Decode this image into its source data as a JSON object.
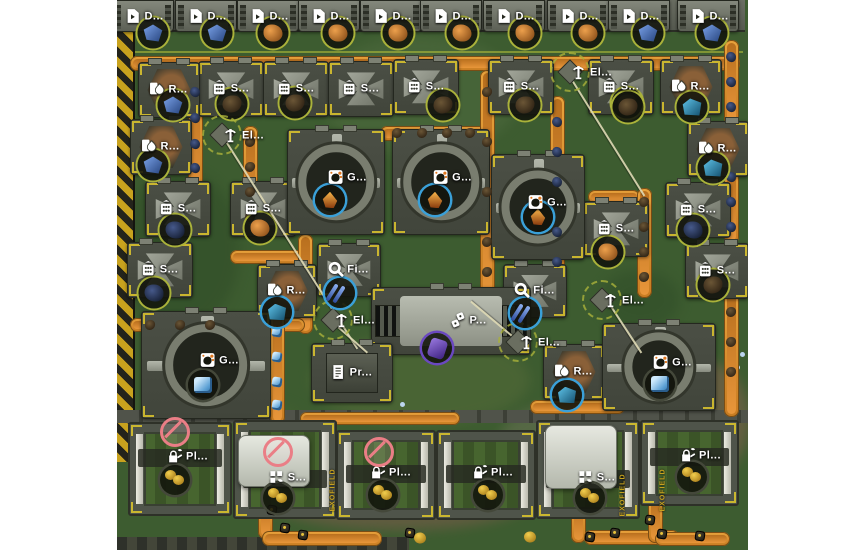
{
  "app": {
    "name": "factory-colony-game-map"
  },
  "labels": {
    "digger": "D...",
    "smelter": "S...",
    "refinery": "R...",
    "generator": "G...",
    "filter": "Fi...",
    "pole": "El...",
    "press": "P...",
    "printer": "Pr...",
    "planter": "Pl...",
    "sower": "S...",
    "exofield": "EXOFIELD"
  },
  "palette": {
    "page_bg": "#ffffff",
    "ground": "#3d5c30",
    "belt": "#d8902e",
    "hazard_yellow": "#c8a21e",
    "tile_grey": "#4b4f45",
    "ring_olive": "#aab23a",
    "ring_cyan": "#3aa0d8",
    "ring_purple": "#6a48c0",
    "label_text": "#ffffff",
    "prohibit_red": "#ea7e86",
    "exofield_gold": "#c8a21e"
  },
  "stage": {
    "left": 117,
    "top": 0,
    "width": 631,
    "height": 550
  },
  "diggers": {
    "y": 0,
    "w": 60,
    "h": 30,
    "xs": [
      142,
      205,
      267,
      328,
      390,
      450,
      513,
      577,
      638,
      707
    ]
  },
  "ore_nodes": [
    {
      "x": 153,
      "y": 33,
      "k": "blue"
    },
    {
      "x": 217,
      "y": 33,
      "k": "blue"
    },
    {
      "x": 273,
      "y": 33,
      "k": "orange"
    },
    {
      "x": 338,
      "y": 33,
      "k": "orange"
    },
    {
      "x": 398,
      "y": 33,
      "k": "orange"
    },
    {
      "x": 462,
      "y": 33,
      "k": "orange"
    },
    {
      "x": 525,
      "y": 33,
      "k": "orange"
    },
    {
      "x": 588,
      "y": 33,
      "k": "orange"
    },
    {
      "x": 648,
      "y": 33,
      "k": "blue"
    },
    {
      "x": 712,
      "y": 33,
      "k": "blue"
    },
    {
      "x": 232,
      "y": 104,
      "k": "dark"
    },
    {
      "x": 295,
      "y": 103,
      "k": "dark"
    },
    {
      "x": 443,
      "y": 105,
      "k": "dark"
    },
    {
      "x": 525,
      "y": 105,
      "k": "dark"
    },
    {
      "x": 627,
      "y": 103,
      "k": "dark"
    },
    {
      "x": 173,
      "y": 105,
      "k": "blue"
    },
    {
      "x": 692,
      "y": 107,
      "k": "teal"
    },
    {
      "x": 628,
      "y": 107,
      "k": "dark"
    },
    {
      "x": 153,
      "y": 165,
      "k": "blue"
    },
    {
      "x": 713,
      "y": 168,
      "k": "teal"
    },
    {
      "x": 175,
      "y": 230,
      "k": "darkblue"
    },
    {
      "x": 260,
      "y": 228,
      "k": "orange"
    },
    {
      "x": 154,
      "y": 293,
      "k": "darkblue"
    },
    {
      "x": 693,
      "y": 230,
      "k": "darkblue"
    },
    {
      "x": 713,
      "y": 285,
      "k": "dark"
    },
    {
      "x": 608,
      "y": 252,
      "k": "orange"
    }
  ],
  "buildings": [
    {
      "t": "smelter",
      "x": 230,
      "y": 88,
      "w": 64,
      "h": 54
    },
    {
      "t": "smelter",
      "x": 295,
      "y": 88,
      "w": 64,
      "h": 54
    },
    {
      "t": "smelter",
      "x": 360,
      "y": 88,
      "w": 64,
      "h": 54
    },
    {
      "t": "smelter",
      "x": 425,
      "y": 86,
      "w": 64,
      "h": 54
    },
    {
      "t": "smelter",
      "x": 520,
      "y": 86,
      "w": 64,
      "h": 54
    },
    {
      "t": "smelter",
      "x": 620,
      "y": 86,
      "w": 64,
      "h": 54
    },
    {
      "t": "smelter",
      "x": 177,
      "y": 208,
      "w": 64,
      "h": 54
    },
    {
      "t": "smelter",
      "x": 262,
      "y": 208,
      "w": 64,
      "h": 54
    },
    {
      "t": "smelter",
      "x": 159,
      "y": 269,
      "w": 64,
      "h": 54
    },
    {
      "t": "smelter",
      "x": 615,
      "y": 228,
      "w": 64,
      "h": 54
    },
    {
      "t": "smelter",
      "x": 697,
      "y": 209,
      "w": 64,
      "h": 54
    },
    {
      "t": "smelter",
      "x": 716,
      "y": 270,
      "w": 62,
      "h": 54
    },
    {
      "t": "refinery",
      "x": 168,
      "y": 89,
      "w": 60,
      "h": 54
    },
    {
      "t": "refinery",
      "x": 690,
      "y": 86,
      "w": 60,
      "h": 54
    },
    {
      "t": "refinery",
      "x": 160,
      "y": 146,
      "w": 60,
      "h": 54
    },
    {
      "t": "refinery",
      "x": 717,
      "y": 148,
      "w": 60,
      "h": 54
    },
    {
      "t": "refinery",
      "x": 286,
      "y": 290,
      "w": 58,
      "h": 52
    },
    {
      "t": "refinery",
      "x": 573,
      "y": 371,
      "w": 60,
      "h": 54
    },
    {
      "t": "filter",
      "x": 348,
      "y": 269,
      "w": 62,
      "h": 52
    },
    {
      "t": "filter",
      "x": 534,
      "y": 290,
      "w": 62,
      "h": 52
    },
    {
      "t": "generator",
      "x": 335,
      "y": 181,
      "w": 96,
      "h": 104,
      "dx": 12
    },
    {
      "t": "generator",
      "x": 440,
      "y": 181,
      "w": 96,
      "h": 104,
      "dx": 12
    },
    {
      "t": "generator",
      "x": 537,
      "y": 206,
      "w": 92,
      "h": 104,
      "dx": 10
    },
    {
      "t": "generator",
      "x": 205,
      "y": 364,
      "w": 128,
      "h": 106,
      "dx": 14
    },
    {
      "t": "generator",
      "x": 658,
      "y": 366,
      "w": 112,
      "h": 86,
      "dx": 14
    },
    {
      "t": "press",
      "x": 450,
      "y": 320,
      "w": 158,
      "h": 66,
      "dx": 18
    },
    {
      "t": "printer",
      "x": 351,
      "y": 372,
      "w": 80,
      "h": 58
    }
  ],
  "poles": [
    {
      "x": 222,
      "y": 135
    },
    {
      "x": 570,
      "y": 72
    },
    {
      "x": 333,
      "y": 320
    },
    {
      "x": 518,
      "y": 342
    },
    {
      "x": 602,
      "y": 300
    }
  ],
  "products": [
    {
      "x": 330,
      "y": 200,
      "k": "flame",
      "ring": "cyan"
    },
    {
      "x": 435,
      "y": 200,
      "k": "flame",
      "ring": "cyan"
    },
    {
      "x": 538,
      "y": 217,
      "k": "flame",
      "ring": "cyan"
    },
    {
      "x": 340,
      "y": 293,
      "k": "sticks",
      "ring": "cyan"
    },
    {
      "x": 525,
      "y": 313,
      "k": "sticks",
      "ring": "cyan"
    },
    {
      "x": 437,
      "y": 348,
      "k": "purple",
      "ring": "purple"
    },
    {
      "x": 203,
      "y": 385,
      "k": "glass",
      "ring": "dark"
    },
    {
      "x": 660,
      "y": 384,
      "k": "glass",
      "ring": "dark"
    },
    {
      "x": 567,
      "y": 395,
      "k": "teal",
      "ring": "cyan"
    },
    {
      "x": 277,
      "y": 312,
      "k": "teal",
      "ring": "cyan"
    },
    {
      "x": 175,
      "y": 480,
      "k": "fruit",
      "ring": "dark"
    },
    {
      "x": 278,
      "y": 498,
      "k": "fruit",
      "ring": "dark"
    },
    {
      "x": 383,
      "y": 495,
      "k": "fruit",
      "ring": "dark"
    },
    {
      "x": 488,
      "y": 495,
      "k": "fruit",
      "ring": "dark"
    },
    {
      "x": 590,
      "y": 498,
      "k": "fruit",
      "ring": "dark"
    },
    {
      "x": 692,
      "y": 477,
      "k": "fruit",
      "ring": "dark"
    }
  ],
  "belts": [
    [
      130,
      56,
      610,
      15
    ],
    [
      188,
      70,
      15,
      140
    ],
    [
      243,
      126,
      15,
      112
    ],
    [
      230,
      250,
      80,
      14
    ],
    [
      298,
      234,
      15,
      100
    ],
    [
      380,
      126,
      108,
      15
    ],
    [
      480,
      70,
      15,
      240
    ],
    [
      550,
      96,
      15,
      190
    ],
    [
      588,
      190,
      52,
      14
    ],
    [
      637,
      188,
      15,
      110
    ],
    [
      724,
      40,
      15,
      85
    ],
    [
      724,
      166,
      15,
      78
    ],
    [
      130,
      318,
      175,
      14
    ],
    [
      270,
      312,
      15,
      112
    ],
    [
      724,
      292,
      15,
      125
    ],
    [
      530,
      400,
      95,
      14
    ],
    [
      300,
      412,
      160,
      13
    ],
    [
      258,
      497,
      15,
      42
    ],
    [
      262,
      531,
      120,
      15
    ],
    [
      571,
      503,
      15,
      40
    ],
    [
      584,
      530,
      95,
      15
    ],
    [
      648,
      498,
      15,
      45
    ],
    [
      655,
      532,
      75,
      14
    ]
  ],
  "belt_items": [
    [
      195,
      92,
      "blue"
    ],
    [
      195,
      118,
      "blue"
    ],
    [
      195,
      144,
      "blue"
    ],
    [
      195,
      168,
      "blue"
    ],
    [
      557,
      122,
      "blue"
    ],
    [
      557,
      152,
      "blue"
    ],
    [
      557,
      182,
      "blue"
    ],
    [
      557,
      232,
      "blue"
    ],
    [
      557,
      262,
      "blue"
    ],
    [
      731,
      57,
      "blue"
    ],
    [
      731,
      82,
      "blue"
    ],
    [
      731,
      107,
      "blue"
    ],
    [
      731,
      177,
      "blue"
    ],
    [
      731,
      202,
      "blue"
    ],
    [
      731,
      227,
      "blue"
    ],
    [
      250,
      142,
      "dark"
    ],
    [
      250,
      167,
      "dark"
    ],
    [
      250,
      192,
      "dark"
    ],
    [
      250,
      217,
      "dark"
    ],
    [
      397,
      133,
      "dark"
    ],
    [
      422,
      133,
      "dark"
    ],
    [
      447,
      133,
      "dark"
    ],
    [
      470,
      133,
      "dark"
    ],
    [
      487,
      92,
      "dark"
    ],
    [
      487,
      142,
      "dark"
    ],
    [
      487,
      192,
      "dark"
    ],
    [
      487,
      242,
      "dark"
    ],
    [
      487,
      272,
      "dark"
    ],
    [
      644,
      202,
      "dark"
    ],
    [
      644,
      227,
      "dark"
    ],
    [
      644,
      252,
      "dark"
    ],
    [
      644,
      277,
      "dark"
    ],
    [
      731,
      312,
      "dark"
    ],
    [
      731,
      342,
      "dark"
    ],
    [
      731,
      372,
      "dark"
    ],
    [
      150,
      325,
      "dark"
    ],
    [
      180,
      325,
      "dark"
    ],
    [
      210,
      325,
      "dark"
    ],
    [
      277,
      332,
      "glass"
    ],
    [
      277,
      357,
      "glass"
    ],
    [
      277,
      382,
      "glass"
    ],
    [
      277,
      405,
      "glass"
    ],
    [
      272,
      510,
      "seed"
    ],
    [
      285,
      528,
      "seed"
    ],
    [
      303,
      535,
      "seed"
    ],
    [
      410,
      533,
      "seed"
    ],
    [
      590,
      537,
      "seed"
    ],
    [
      615,
      533,
      "seed"
    ],
    [
      650,
      520,
      "seed"
    ],
    [
      662,
      534,
      "seed"
    ],
    [
      700,
      536,
      "seed"
    ],
    [
      420,
      538,
      "fruitS"
    ],
    [
      530,
      537,
      "fruitS"
    ]
  ],
  "power_lines": [
    [
      225,
      138,
      358,
      348
    ],
    [
      570,
      75,
      645,
      195
    ],
    [
      610,
      303,
      642,
      352
    ],
    [
      520,
      344,
      470,
      302
    ],
    [
      335,
      323,
      368,
      352
    ]
  ],
  "fields": [
    {
      "x": 128,
      "y": 422,
      "w": 100,
      "h": 90,
      "t": "planter",
      "lx": 187,
      "ly": 456,
      "red": [
        175,
        432
      ]
    },
    {
      "x": 233,
      "y": 420,
      "w": 100,
      "h": 95,
      "t": "sower",
      "lx": 287,
      "ly": 477,
      "red": [
        278,
        452
      ],
      "veh": [
        238,
        435,
        70,
        50
      ]
    },
    {
      "x": 336,
      "y": 430,
      "w": 96,
      "h": 86,
      "t": "planter",
      "lx": 390,
      "ly": 472,
      "red": [
        379,
        452
      ]
    },
    {
      "x": 436,
      "y": 430,
      "w": 96,
      "h": 86,
      "t": "planter",
      "lx": 492,
      "ly": 472
    },
    {
      "x": 536,
      "y": 420,
      "w": 100,
      "h": 95,
      "t": "sower",
      "lx": 596,
      "ly": 477,
      "veh": [
        545,
        425,
        70,
        62
      ]
    },
    {
      "x": 640,
      "y": 420,
      "w": 95,
      "h": 82,
      "t": "planter",
      "lx": 700,
      "ly": 455
    }
  ],
  "exofield_marks": [
    [
      333,
      490
    ],
    [
      623,
      495
    ],
    [
      663,
      490
    ]
  ]
}
